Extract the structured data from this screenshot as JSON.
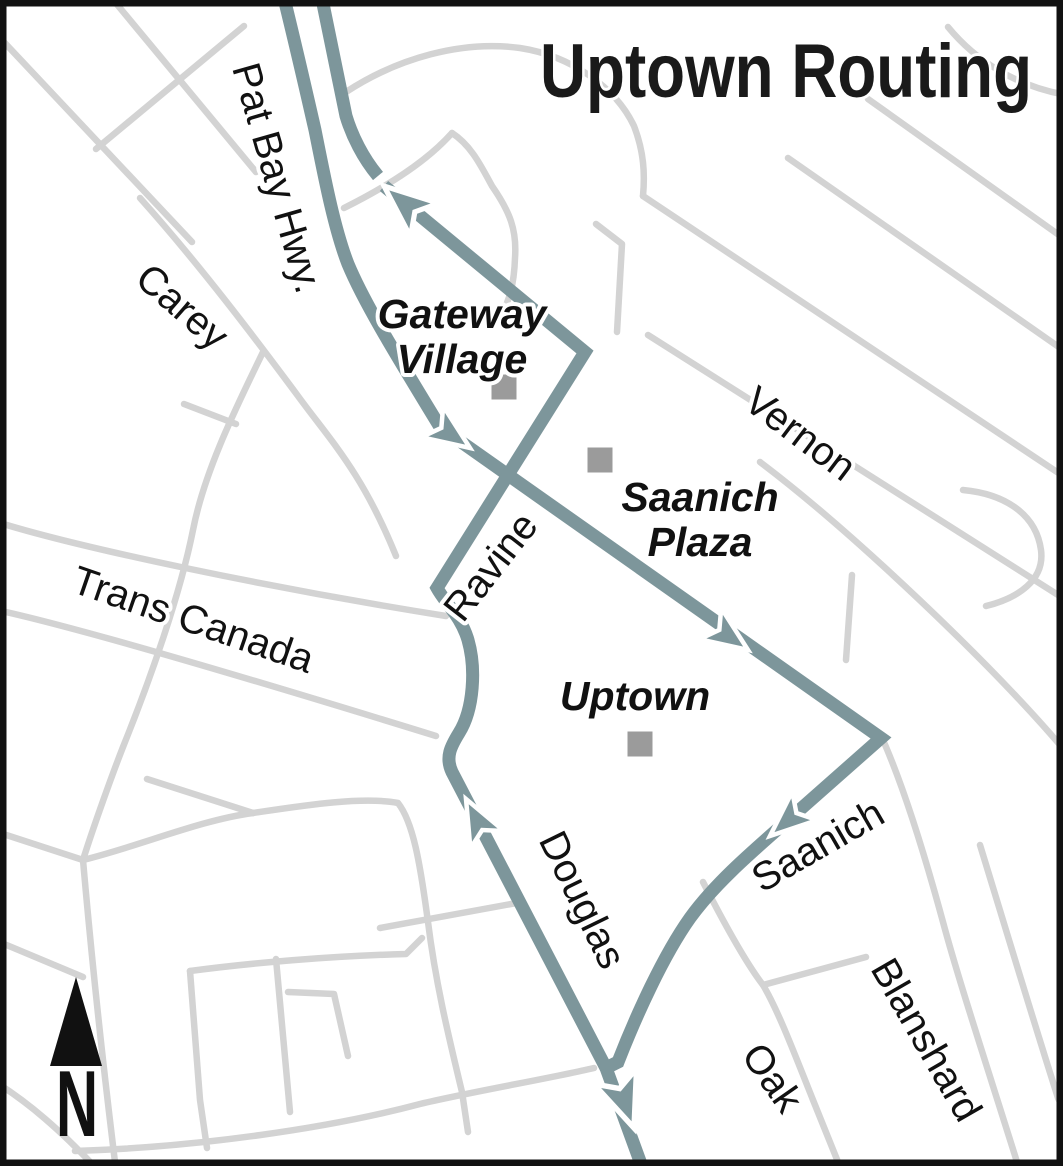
{
  "title": "Uptown Routing",
  "map": {
    "colors": {
      "background": "#FFFFFF",
      "border": "#111111",
      "minor_road": "#D3D3D3",
      "route": "#7D969B",
      "arrow_casing": "#FFFFFF",
      "marker": "#9B9B9B",
      "label_text": "#111111"
    },
    "north": {
      "label": "N"
    },
    "street_labels": [
      {
        "name": "pat-bay-hwy",
        "text": "Pat Bay Hwy."
      },
      {
        "name": "carey",
        "text": "Carey"
      },
      {
        "name": "trans-canada",
        "text": "Trans Canada"
      },
      {
        "name": "vernon",
        "text": "Vernon"
      },
      {
        "name": "ravine",
        "text": "Ravine"
      },
      {
        "name": "douglas",
        "text": "Douglas"
      },
      {
        "name": "saanich-road",
        "text": "Saanich"
      },
      {
        "name": "oak",
        "text": "Oak"
      },
      {
        "name": "blanshard",
        "text": "Blanshard"
      }
    ],
    "place_labels": [
      {
        "name": "gateway-village",
        "lines": [
          "Gateway",
          "Village"
        ]
      },
      {
        "name": "saanich-plaza",
        "lines": [
          "Saanich",
          "Plaza"
        ]
      },
      {
        "name": "uptown",
        "lines": [
          "Uptown"
        ]
      }
    ],
    "geometry": {
      "minor_road_width": 6.5,
      "route_width": 13,
      "roads": [
        "M 110 -4 L 256 172",
        "M 2 40 L 192 242",
        "M 244 26 L 96 149",
        "M 140 198 C 200 265, 258 342, 298 396 C 330 440, 362 472, 396 556",
        "M 184 404 L 236 424",
        "M 263 352 C 240 400, 205 468, 193 530 C 180 595, 150 680, 123 747 C 112 775, 93 828, 83 860",
        "M -3 522 C 80 548, 270 588, 446 616",
        "M -3 610 C 90 630, 300 694, 436 736",
        "M -3 832 L 83 860",
        "M 83 860 C 140 846, 200 820, 253 813",
        "M 147 779 L 253 813",
        "M 253 813 C 300 806, 362 796, 398 803 C 413 822, 420 862, 428 922 C 436 986, 450 1042, 462 1092 L 468 1132",
        "M -3 941 L 83 977",
        "M 83 860 C 90 940, 100 1040, 115 1162",
        "M -3 1083 C 30 1104, 60 1130, 94 1166",
        "M 75 1151 C 200 1147, 330 1128, 420 1104 C 470 1092, 552 1078, 594 1068",
        "M 190 971 L 200 1100 L 207 1148",
        "M 190 971 C 250 963, 330 956, 406 954 L 422 938",
        "M 276 959 L 290 1112",
        "M 288 992 L 334 994 L 348 1056",
        "M 380 928 L 522 902",
        "M 703 882 C 725 925, 746 963, 763 985 C 778 1010, 795 1055, 813 1100 L 838 1162",
        "M 763 985 L 866 957",
        "M 883 740 C 905 790, 925 856, 943 922 C 958 978, 985 1060, 1017 1162",
        "M 980 845 C 1000 910, 1030 1010, 1058 1098 L 1066 1114",
        "M 648 335 L 1066 600",
        "M 760 462 C 850 530, 990 662, 1066 752",
        "M 852 575 L 846 660",
        "M 963 490 C 1005 494, 1036 514, 1041 550 C 1045 580, 1018 598, 986 606",
        "M 643 196 L 1066 478",
        "M 788 158 L 1066 352",
        "M 868 99 L 1066 240",
        "M 948 27 C 975 60, 1015 86, 1066 95",
        "M 346 92 C 398 58, 462 40, 520 48 C 572 56, 616 88, 634 126 C 644 152, 645 174, 643 196",
        "M 344 208 C 392 184, 428 160, 452 133",
        "M 452 133 C 472 146, 482 168, 492 186 C 510 212, 517 230, 515 258 C 514 288, 508 302, 502 314",
        "M 596 224 L 622 244 L 617 332"
      ],
      "route_paths": [
        "M 283 -6 C 298 55, 307 95, 315 130 C 324 175, 334 228, 348 264 C 363 300, 390 345, 440 427 L 881 738 L 795 814 C 754 850, 716 882, 690 918 C 663 956, 636 1016, 618 1062 L 606 1068 L 641 1164",
        "M 606 1068 L 452 772 C 445 757, 451 746, 459 733 C 474 709, 476 668, 468 640 C 461 616, 445 603, 437 588 L 585 352 L 384 186",
        "M 378 176 C 363 158, 352 136, 346 116 L 321 -6"
      ],
      "arrows": [
        {
          "x": 384,
          "y": 186,
          "angle": 220,
          "s": 1.15
        },
        {
          "x": 470,
          "y": 448,
          "angle": 35,
          "s": 1.0
        },
        {
          "x": 748,
          "y": 650,
          "angle": 35,
          "s": 1.0
        },
        {
          "x": 770,
          "y": 836,
          "angle": 139,
          "s": 1.0
        },
        {
          "x": 466,
          "y": 799,
          "angle": 242.5,
          "s": 1.0
        },
        {
          "x": 634,
          "y": 1128,
          "angle": 70,
          "s": 1.2
        }
      ],
      "markers": [
        {
          "x": 504,
          "y": 387,
          "size": 25
        },
        {
          "x": 600,
          "y": 460,
          "size": 25
        },
        {
          "x": 640,
          "y": 744,
          "size": 25
        }
      ],
      "north_triangle": "76,977 50,1066 102,1066"
    }
  }
}
